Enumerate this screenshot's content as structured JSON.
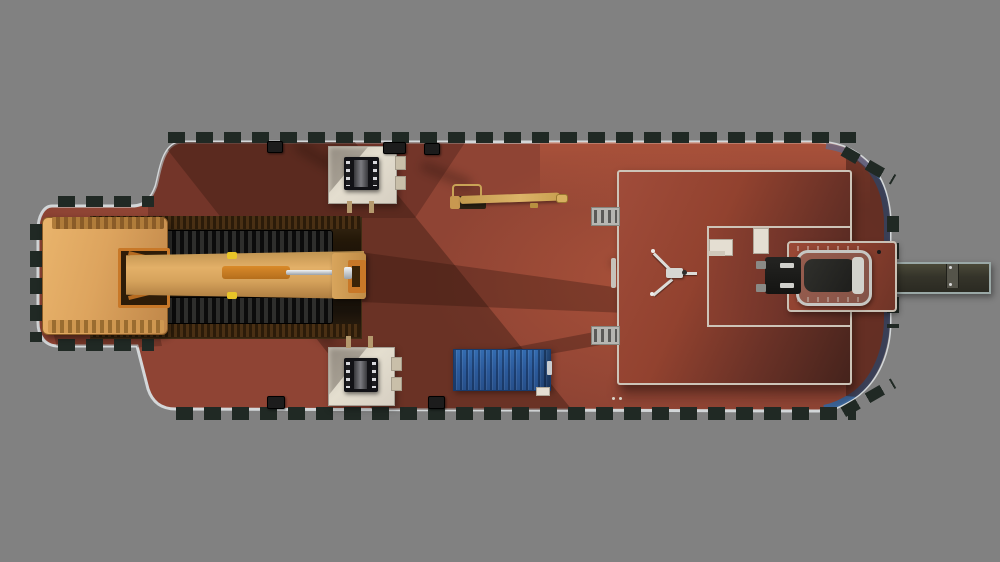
{
  "scene": {
    "type": "3d-render-top-down-view",
    "subject": "red deck barge carrying an excavator, mooring winches, a telescopic crane, a blue shipping container, a deckhouse with antenna mast, a stern vehicle cradle and a gangway ramp",
    "objects": [
      "barge-hull",
      "bow-section",
      "stern-section",
      "hull-fenders",
      "stern-blue-trim",
      "excavator-bucket",
      "excavator-boom",
      "hydraulic-cylinder",
      "crawler-tracks",
      "deck-hatch-recess",
      "mooring-winch-platform-fore",
      "mooring-winch-platform-aft",
      "mooring-winch-fore",
      "mooring-winch-aft",
      "telescopic-crane",
      "shipping-container",
      "deckhouse",
      "deckhouse-courtyard",
      "antenna-tripod",
      "access-ladder-fore",
      "access-ladder-aft",
      "deck-bench",
      "deck-locker",
      "stern-platform",
      "vehicle-on-cradle",
      "gangway-ramp",
      "deck-bollards",
      "bow-mooring-rings"
    ]
  },
  "palette": {
    "background": "#818181",
    "deck": "#8f4434",
    "deck-bright": "#a85240",
    "deck-shadow": "#3f1e16",
    "hull-trim": "#d3d7d9",
    "stern-trim": "#36669e",
    "fender": "#202924",
    "excavator": "#dda45e",
    "excavator-dark": "#b0793a",
    "track": "#141414",
    "pit": "#1a1108",
    "pit-light": "#6b5526",
    "platform": "#ddd6c9",
    "winch": "#17171b",
    "container": "#2b5a9b",
    "crane": "#c9a356",
    "deckhouse-wall": "#cdc4b8",
    "vehicle-frame": "#c6c6c2",
    "vehicle-body": "#1d1d1b",
    "gangway": "#35342a",
    "antenna": "#dcdcd8"
  }
}
